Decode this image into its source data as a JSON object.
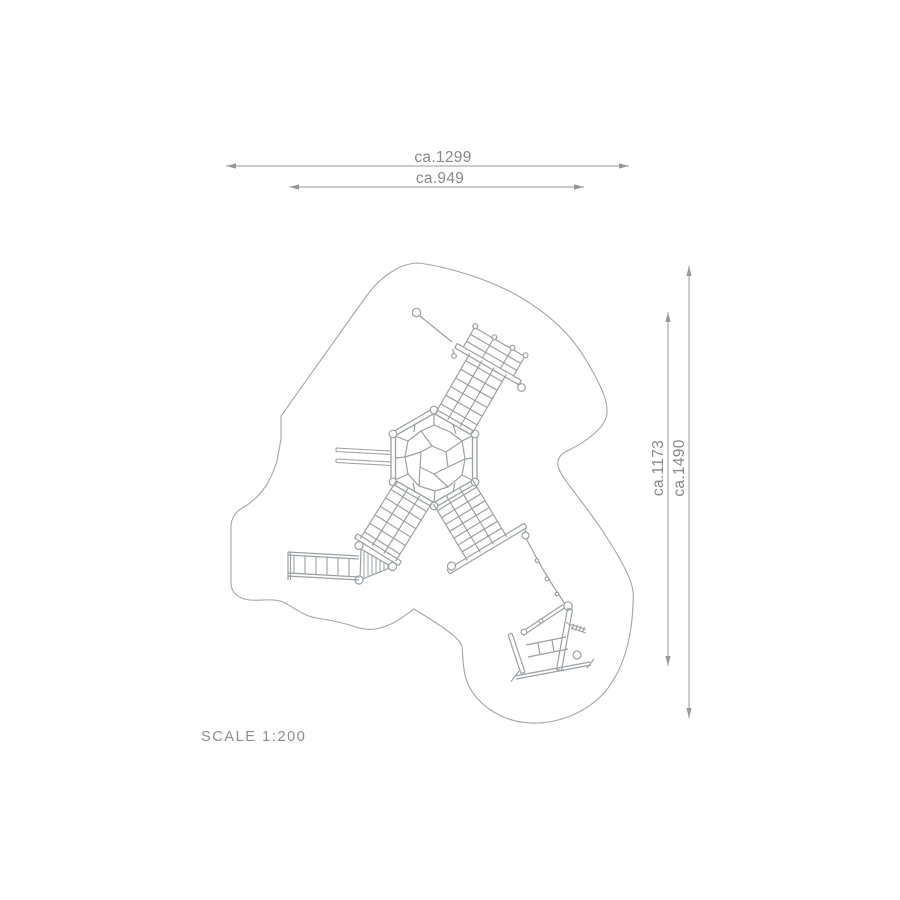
{
  "drawing": {
    "type": "playground-equipment-plan-view",
    "scale_label": "SCALE 1:200",
    "dimensions": {
      "top_outer": "ca.1299",
      "top_inner": "ca.949",
      "right_inner": "ca.1173",
      "right_outer": "ca.1490"
    },
    "colors": {
      "background": "#ffffff",
      "structure_line": "#9aa0a3",
      "outline_line": "#a2a6a9",
      "dimension_line": "#95989b",
      "text": "#85888b"
    }
  }
}
